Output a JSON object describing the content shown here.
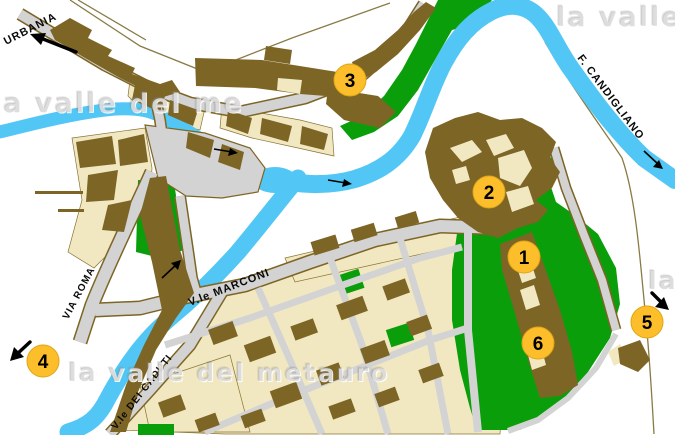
{
  "map": {
    "title": "town map with numbered points of interest",
    "street_labels": {
      "urbania": "URBANIA",
      "via_roma": "VIA ROMA",
      "marconi": "V.le MARCONI",
      "caduti": "V.le DEI CADUTI",
      "candigliano": "F. CANDIGLIANO"
    },
    "markers": [
      {
        "number": "1"
      },
      {
        "number": "2"
      },
      {
        "number": "3"
      },
      {
        "number": "4"
      },
      {
        "number": "5"
      },
      {
        "number": "6"
      }
    ],
    "watermarks": {
      "left": "la valle del me",
      "top_right": "la valle",
      "bottom": "la valle del metauro",
      "right": "la"
    },
    "colors": {
      "building_brown": "#7d6525",
      "parcel_cream": "#f1e8c2",
      "park_green": "#0a9e0a",
      "river_blue": "#52c7f5",
      "road_gray": "#d3d3d3",
      "marker_yellow": "#fcbf2b"
    }
  }
}
